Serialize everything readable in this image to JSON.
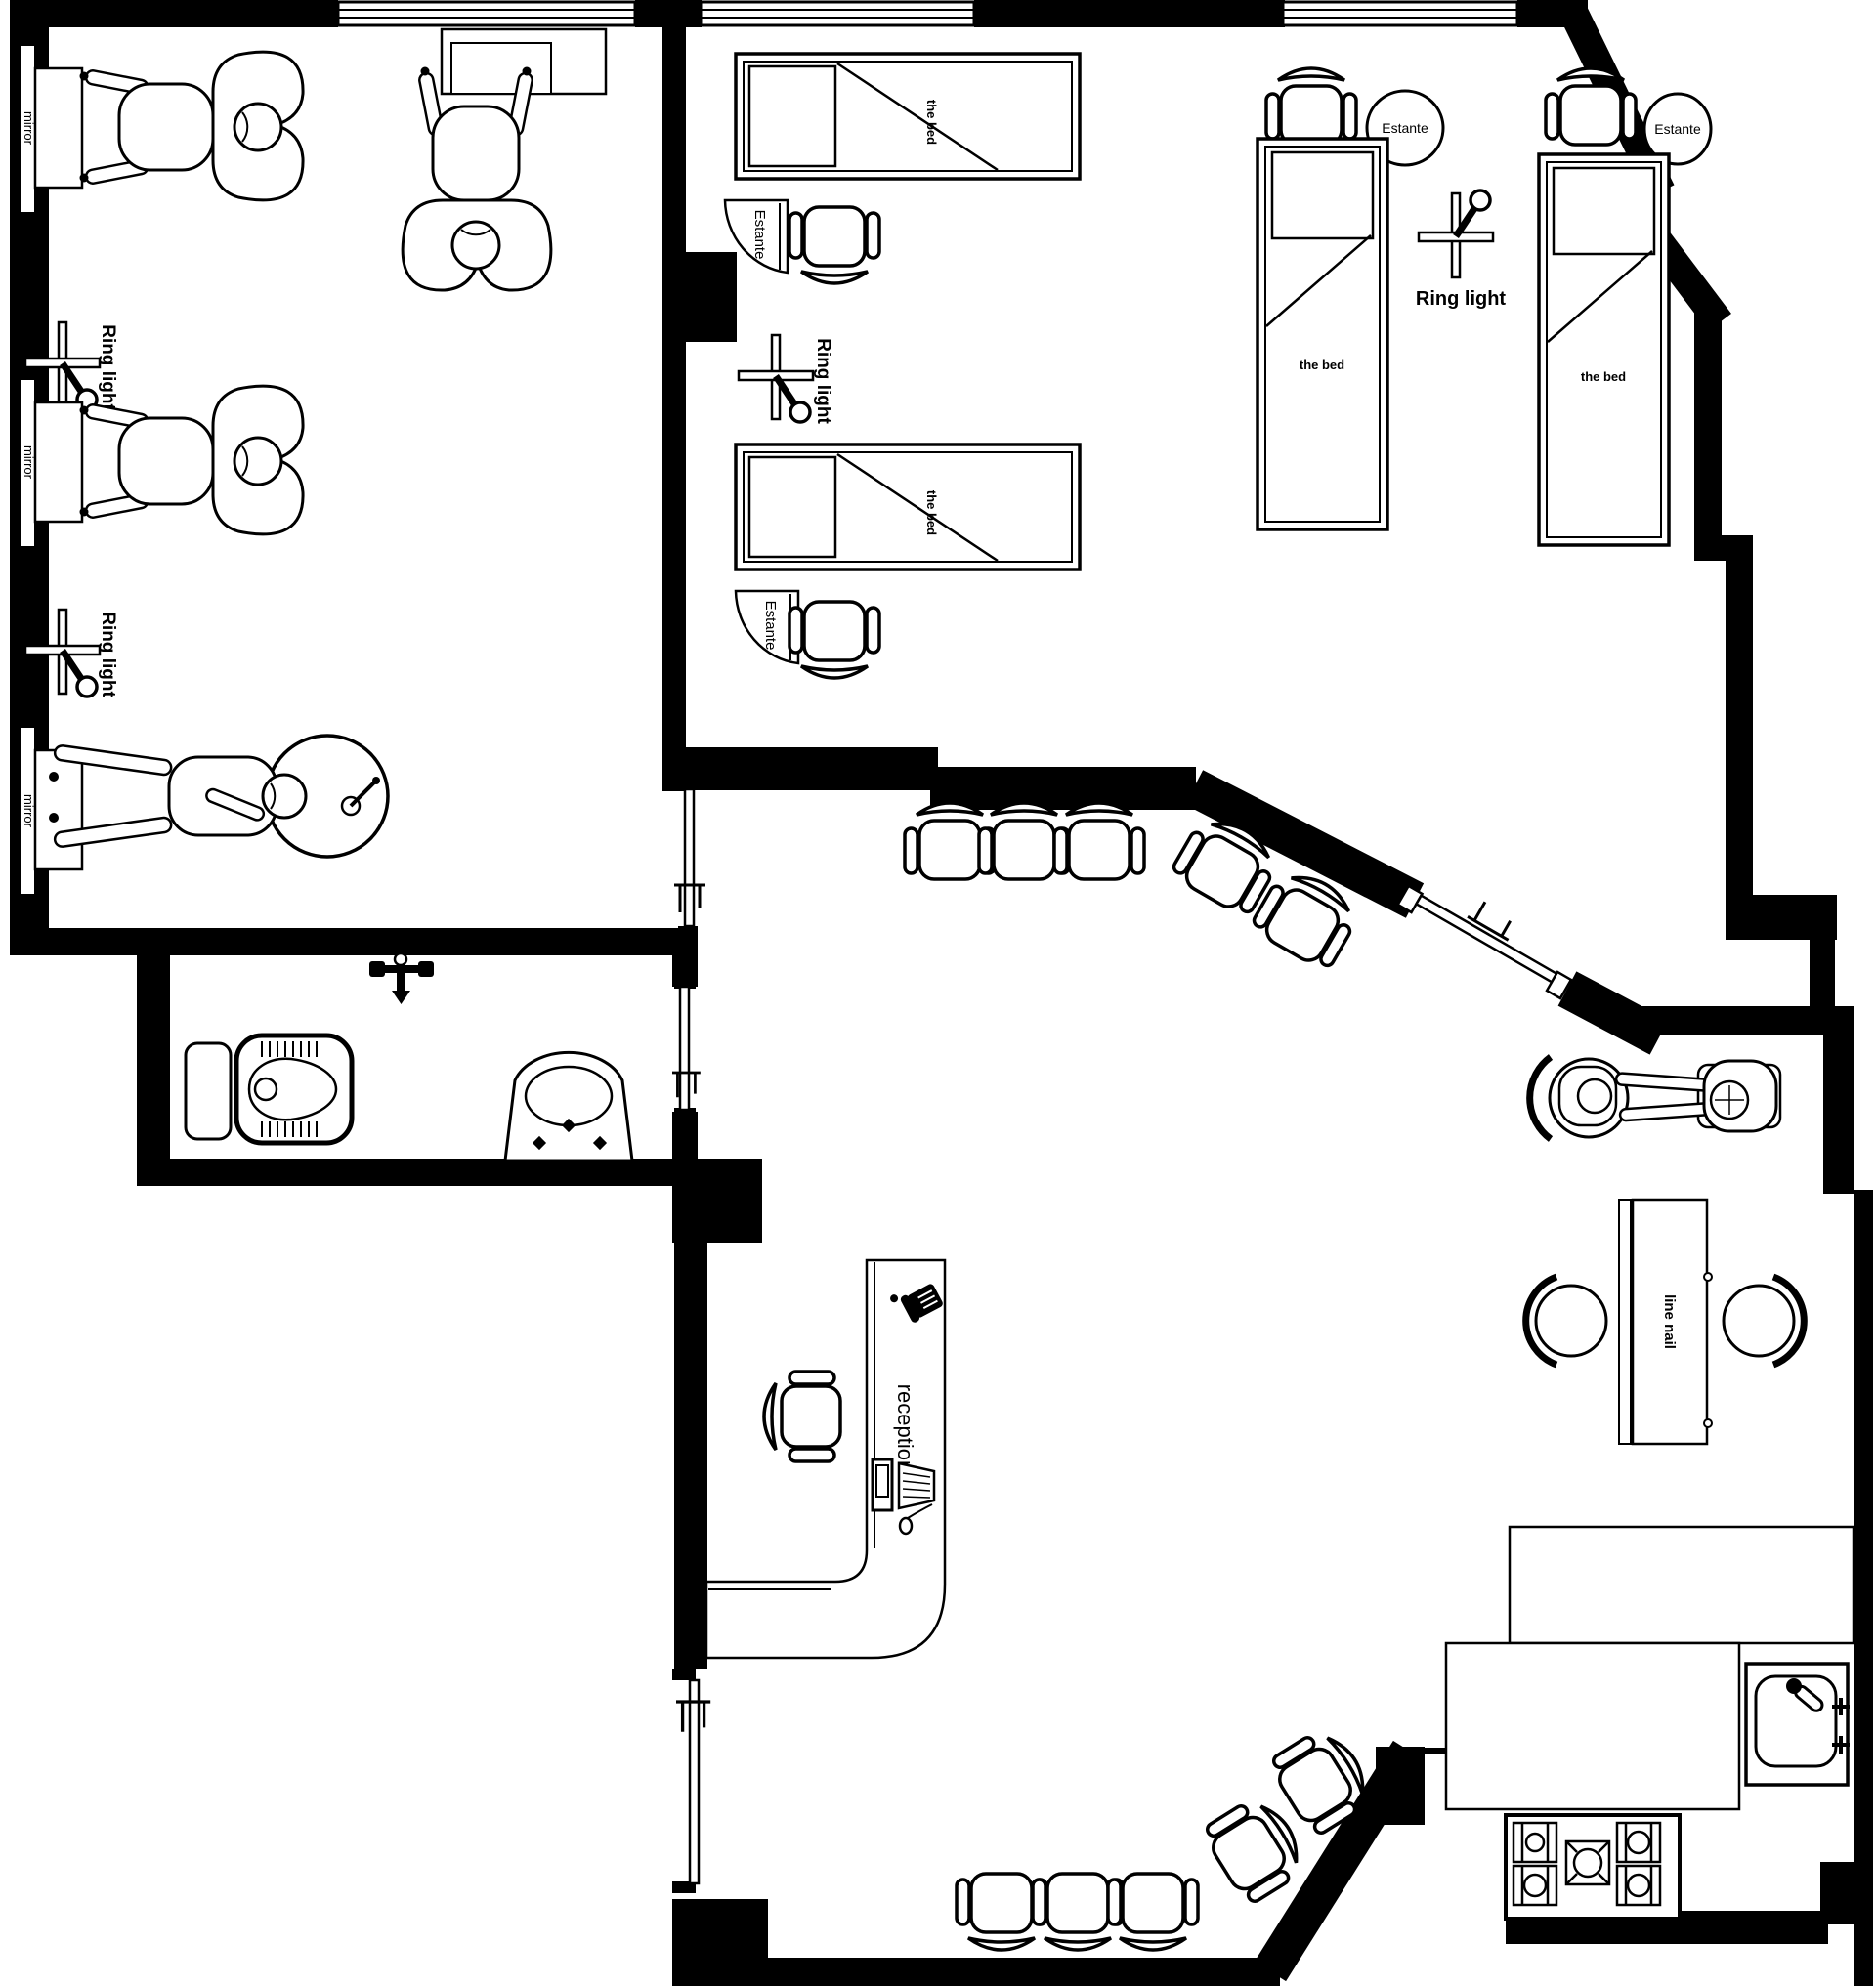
{
  "colors": {
    "wall": "#000000",
    "floor": "#ffffff",
    "line": "#000000"
  },
  "labels": {
    "mirror": "mirror",
    "ring_light": "Ring light",
    "the_bed": "the bed",
    "estante": "Estante",
    "reception": "reception",
    "line_nail": "line nail"
  }
}
